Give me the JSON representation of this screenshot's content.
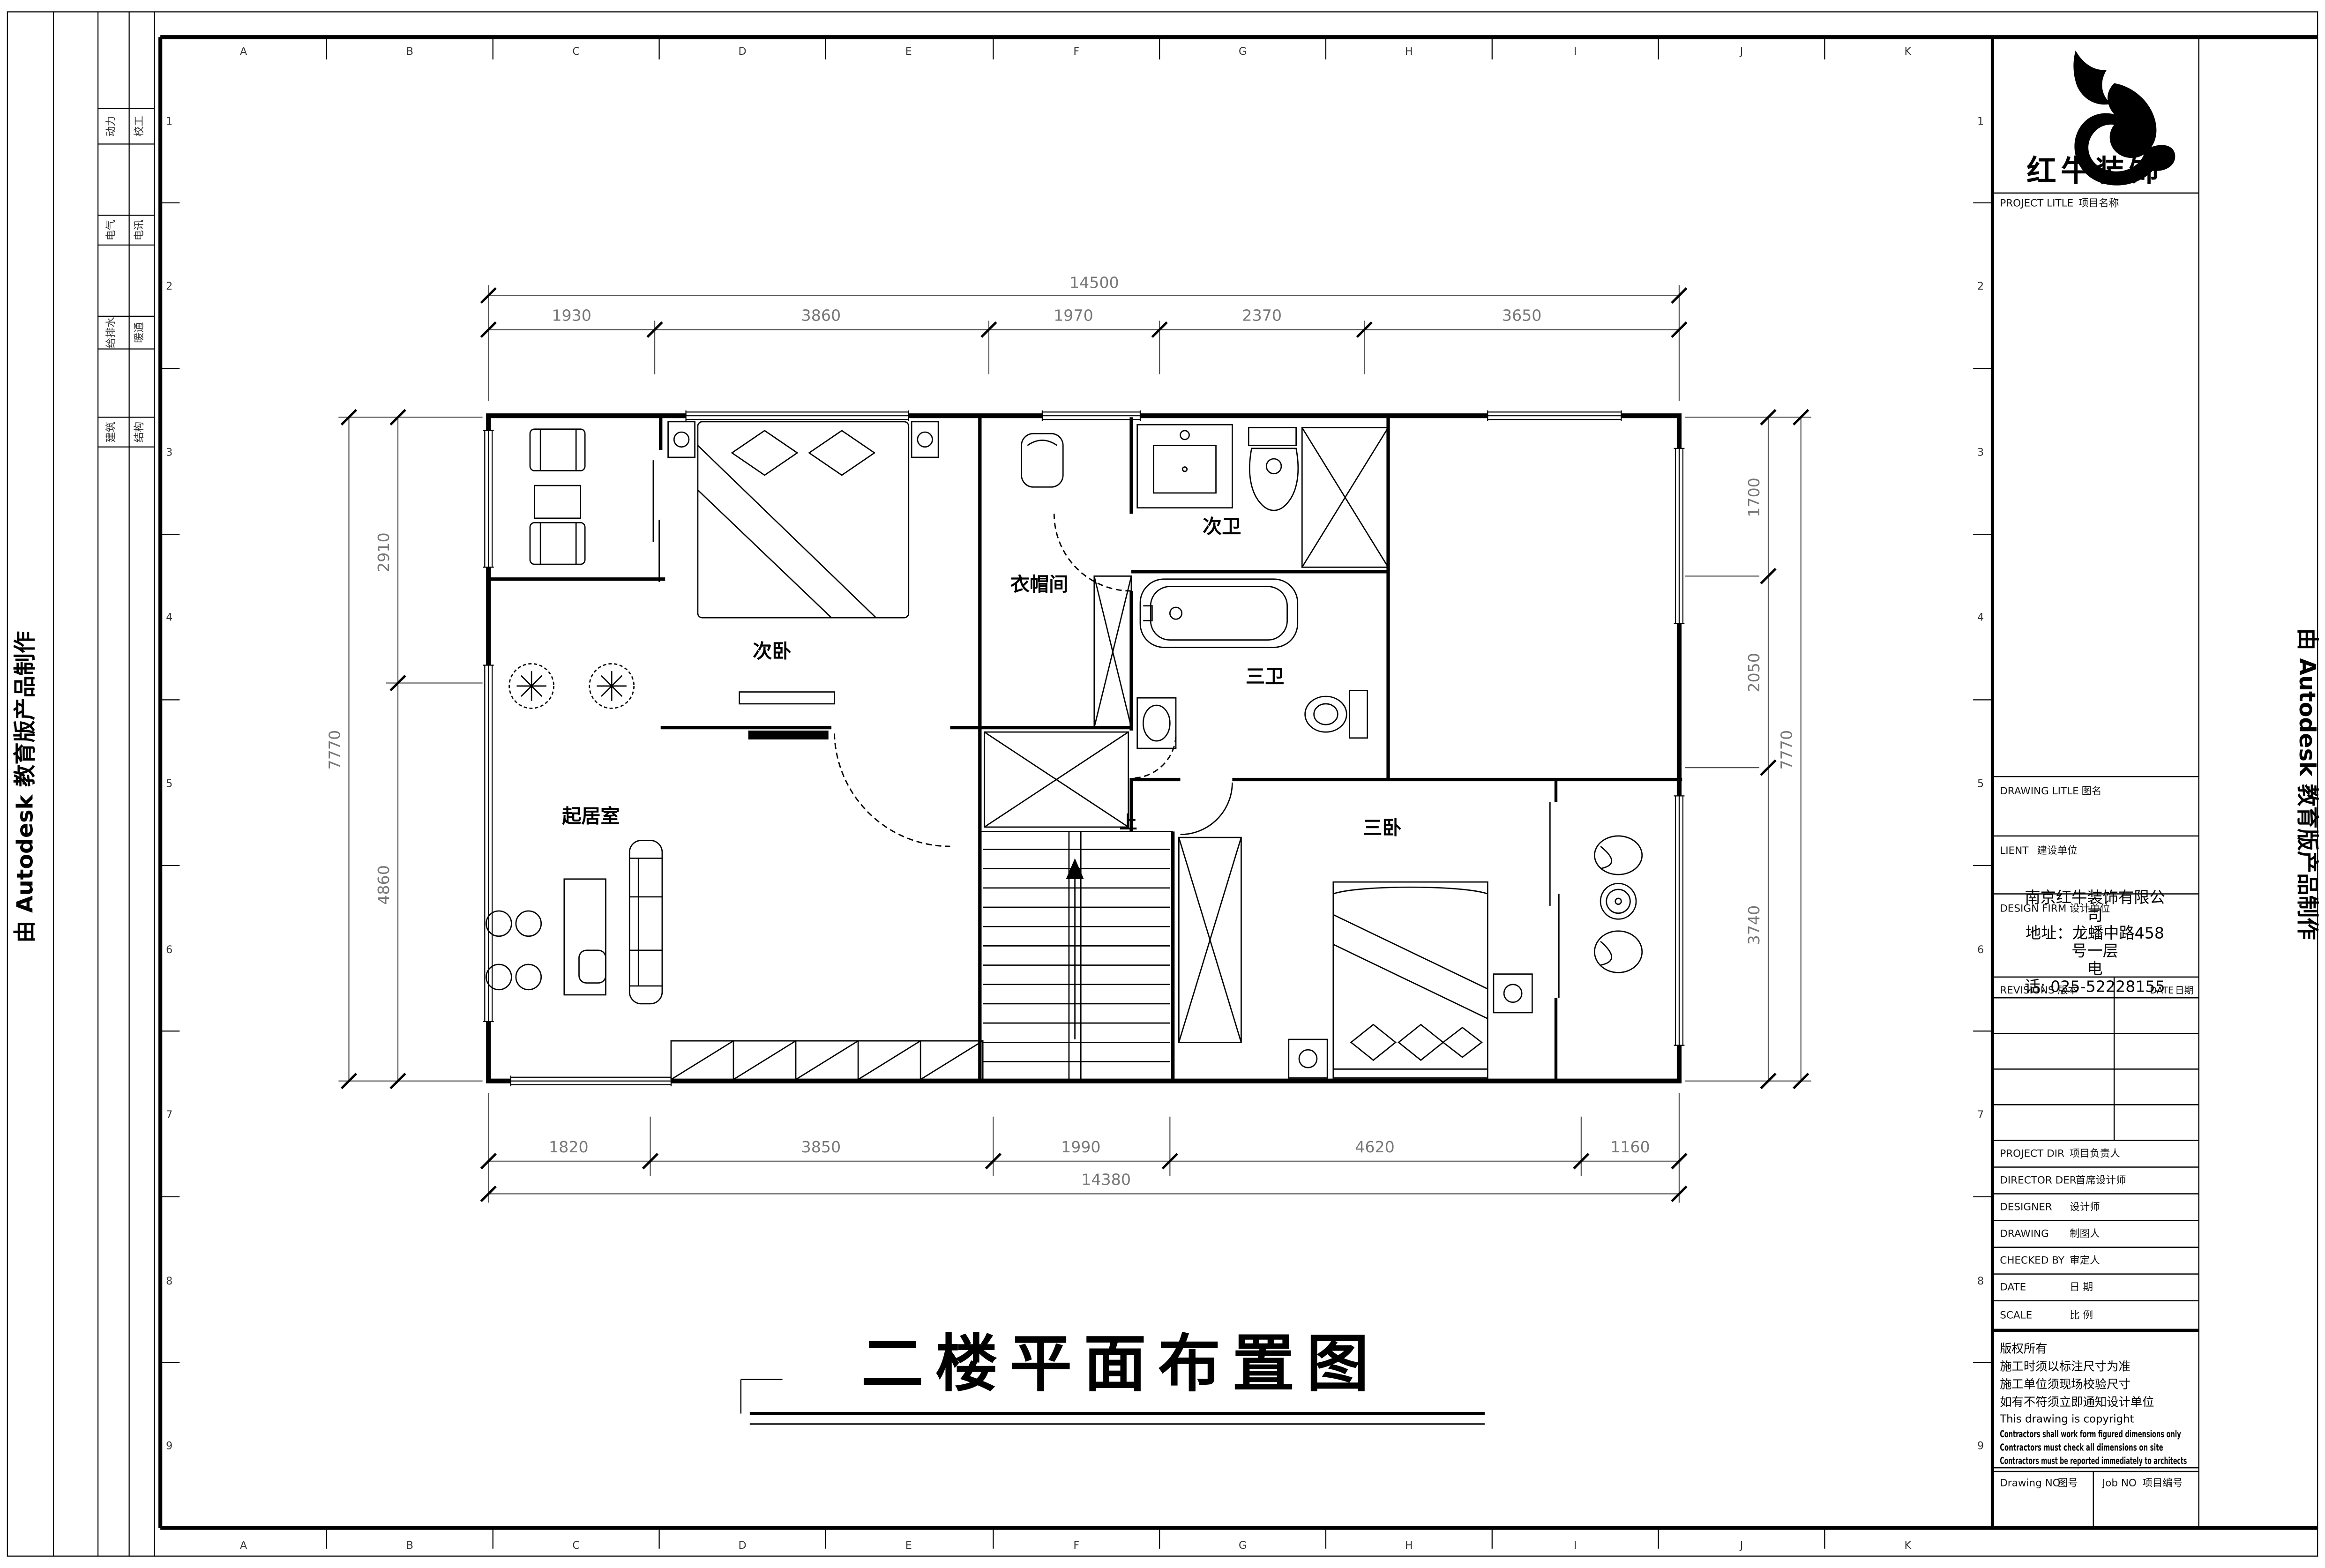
{
  "colors": {
    "ink": "#000000",
    "background": "#ffffff"
  },
  "sheet": {
    "edge_stamp": "由 Autodesk 教育版产品制作",
    "grid_letters": [
      "A",
      "B",
      "C",
      "D",
      "E",
      "F",
      "G",
      "H",
      "I",
      "J",
      "K"
    ],
    "grid_numbers": [
      "1",
      "2",
      "3",
      "4",
      "5",
      "6",
      "7",
      "8",
      "9"
    ],
    "discipline_rows": [
      {
        "left": "动力",
        "right": "校工"
      },
      {
        "left": "电气",
        "right": "电讯"
      },
      {
        "left": "给排水",
        "right": "暖通"
      },
      {
        "left": "建筑",
        "right": "结构"
      }
    ]
  },
  "title_block": {
    "brand": "红牛装饰",
    "fields": {
      "project_litle": {
        "en": "PROJECT LITLE",
        "zh": "项目名称"
      },
      "drawing_litle": {
        "en": "DRAWING LITLE",
        "zh": "图名"
      },
      "client": {
        "en": "LIENT",
        "zh": "建设单位"
      },
      "design_firm": {
        "en": "DESIGN FIRM",
        "zh": "设计单位"
      },
      "revisions": {
        "en": "REVISIONS",
        "zh": "版本"
      },
      "revisions_date": {
        "en": "DATE",
        "zh": "日期"
      },
      "project_dir": {
        "en": "PROJECT DIR",
        "zh": "项目负责人"
      },
      "director": {
        "en": "DIRECTOR DER",
        "zh": "首席设计师"
      },
      "designer": {
        "en": "DESIGNER",
        "zh": "设计师"
      },
      "drawing_by": {
        "en": "DRAWING",
        "zh": "制图人"
      },
      "checked_by": {
        "en": "CHECKED BY",
        "zh": "审定人"
      },
      "date": {
        "en": "DATE",
        "zh": "日 期"
      },
      "scale": {
        "en": "SCALE",
        "zh": "比 例"
      },
      "drawing_no": {
        "en": "Drawing NO",
        "zh": "图号"
      },
      "job_no": {
        "en": "Job NO",
        "zh": "项目编号"
      }
    },
    "firm_info_lines": [
      "南京红牛装饰有限公",
      "司",
      "地址：龙蟠中路458",
      "号一层",
      "电",
      "话: 025-52228155"
    ],
    "copyright_lines": [
      "版权所有",
      "施工时须以标注尺寸为准",
      "施工单位须现场校验尺寸",
      "如有不符须立即通知设计单位",
      "This drawing is copyright",
      "Contractors shall work form figured dimensions only",
      "Contractors must check all dimensions on site",
      "Contractors must be reported immediately to architects"
    ]
  },
  "floor_plan": {
    "title": "二楼平面布置图",
    "stair_up_label": "上",
    "rooms": {
      "secondary_bedroom": "次卧",
      "cloakroom": "衣帽间",
      "secondary_bath": "次卫",
      "third_bath": "三卫",
      "living_room": "起居室",
      "third_bedroom": "三卧"
    },
    "dimensions": {
      "top": {
        "overall": "14500",
        "segments": [
          "1930",
          "3860",
          "1970",
          "2370",
          "3650"
        ]
      },
      "bottom": {
        "overall": "14380",
        "segments": [
          "1820",
          "3850",
          "1990",
          "4620",
          "1160"
        ]
      },
      "left": {
        "overall": "7770",
        "segments": [
          "2910",
          "4860"
        ]
      },
      "right": {
        "overall": "7770",
        "segments": [
          "1700",
          "2050",
          "3740"
        ]
      }
    }
  }
}
